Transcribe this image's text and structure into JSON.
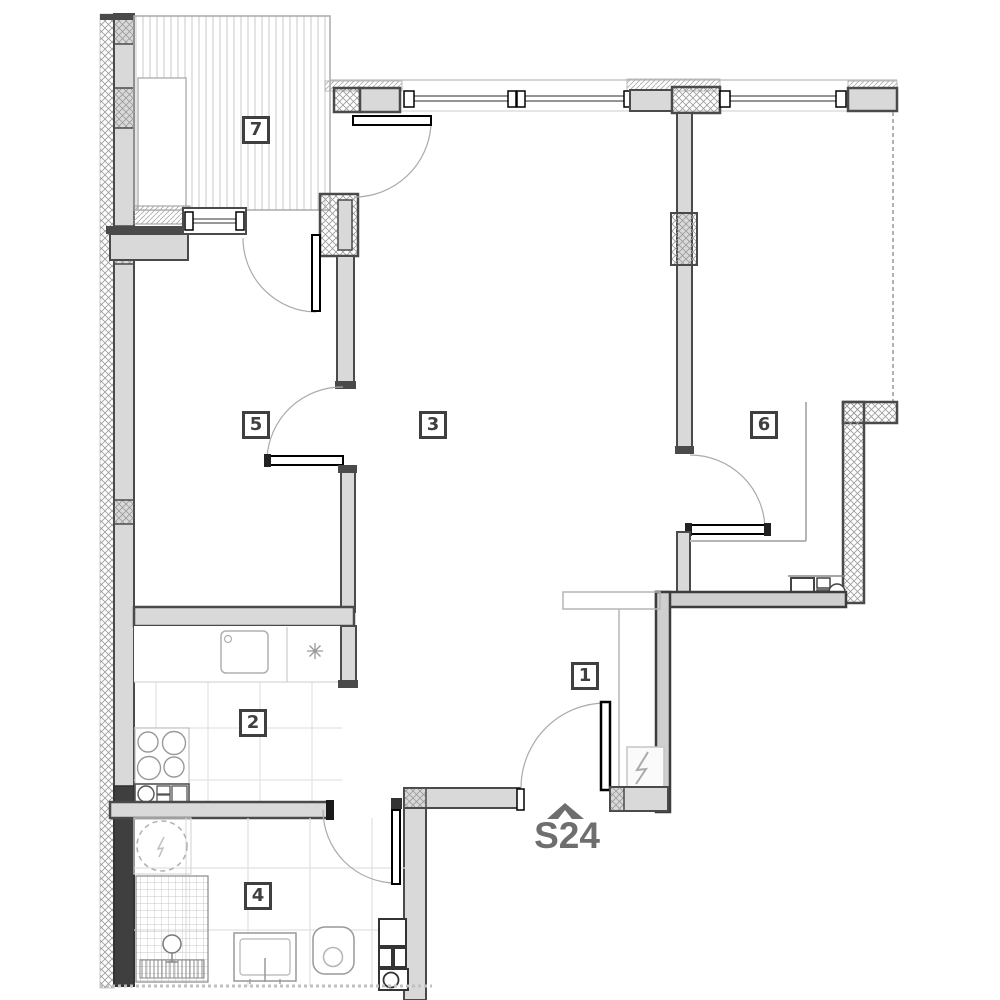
{
  "plan": {
    "title": "apartment-floor-plan",
    "unit_label": "S24",
    "rooms": {
      "r1": {
        "number": "1"
      },
      "r2": {
        "number": "2"
      },
      "r3": {
        "number": "3"
      },
      "r4": {
        "number": "4"
      },
      "r5": {
        "number": "5"
      },
      "r6": {
        "number": "6"
      },
      "r7": {
        "number": "7"
      }
    },
    "icons": [
      "entrance-roof-marker-icon",
      "washing-machine-icon",
      "shower-icon",
      "shower-drain-icon",
      "bathroom-sink-icon",
      "toilet-icon",
      "bathroom-cabinet-icon",
      "cooktop-icon",
      "kitchen-sink-icon",
      "kitchen-appliance-icon",
      "hob-star-icon",
      "kitchenette-sink-icon",
      "electrical-panel-icon",
      "wardrobe-outline",
      "window-symbol",
      "door-swing-arc"
    ],
    "colors": {
      "wall_dark": "#4a4a4a",
      "wall_fill": "#d9d9d9",
      "wall_neighbor_fill": "#cfcfcf",
      "hatch_line": "#9a9a9a",
      "balcony_hatch": "#c9c9c9",
      "tile_line": "#e3e3e3",
      "annotation_gray": "#b5b5b5",
      "door_arc": "#aaaaaa",
      "label_color": "#3f3f3f",
      "unit_label_color": "#6e6e6e"
    }
  }
}
